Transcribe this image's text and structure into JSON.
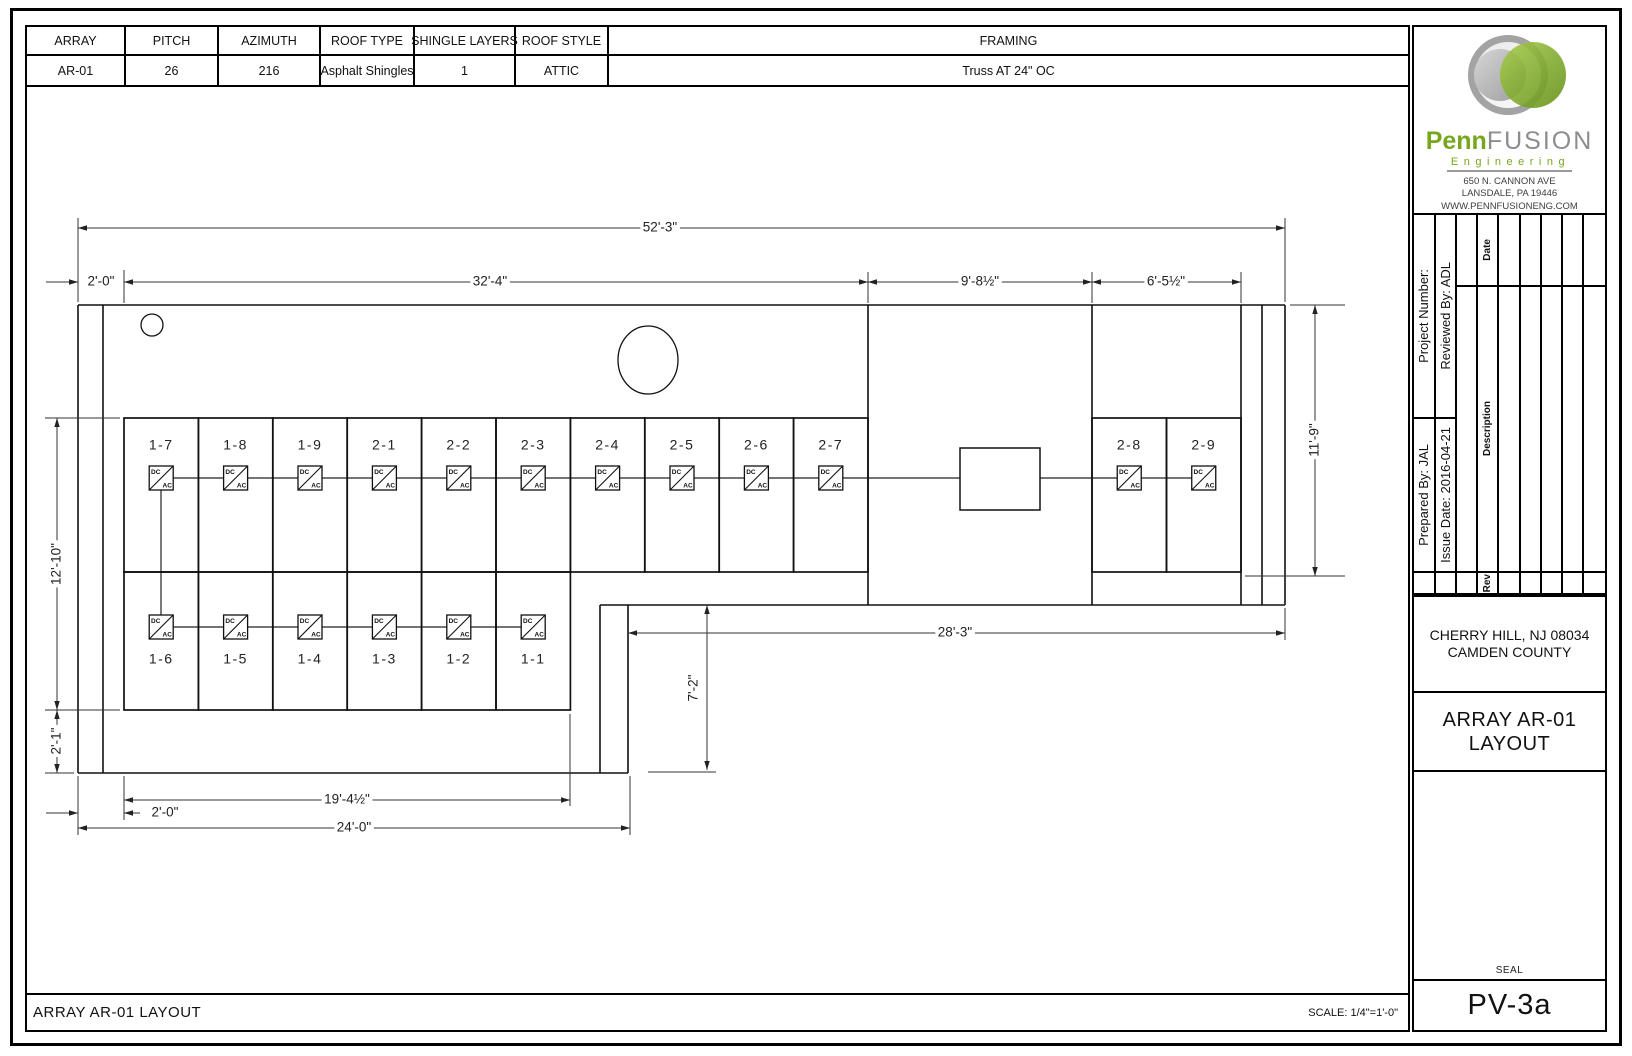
{
  "sheet": {
    "spec_table": {
      "headers": [
        "ARRAY",
        "PITCH",
        "AZIMUTH",
        "ROOF TYPE",
        "SHINGLE LAYERS",
        "ROOF STYLE",
        "FRAMING"
      ],
      "values": [
        "AR-01",
        "26",
        "216",
        "Asphalt Shingles",
        "1",
        "ATTIC",
        "Truss AT 24\" OC"
      ]
    },
    "footer": {
      "title": "ARRAY AR-01 LAYOUT",
      "scale": "SCALE: 1/4\"=1'-0\""
    },
    "title_block": {
      "logo": {
        "brand_primary": "Penn",
        "brand_secondary": "FUSION",
        "tagline": "Engineering",
        "address1": "650 N. CANNON AVE",
        "address2": "LANSDALE, PA 19446",
        "website": "WWW.PENNFUSIONENG.COM",
        "brand_green": "#76a71e",
        "brand_gray": "#8d8d8d"
      },
      "info": {
        "project_number": "Project Number:",
        "prepared_by": "Prepared By: JAL",
        "reviewed_by": "Reviewed By: ADL",
        "issue_date": "Issue Date: 2016-04-21"
      },
      "rev_table": {
        "date_label": "Date",
        "description_label": "Description",
        "rev_label": "Rev",
        "empty_columns": 5
      },
      "location_line1": "CHERRY HILL, NJ 08034",
      "location_line2": "CAMDEN COUNTY",
      "sheet_title_line1": "ARRAY AR-01",
      "sheet_title_line2": "LAYOUT",
      "seal_label": "SEAL",
      "sheet_number": "PV-3a"
    }
  },
  "drawing": {
    "inverter_labels": {
      "dc": "DC",
      "ac": "AC"
    },
    "outline": [
      [
        78,
        305,
        1285,
        305
      ],
      [
        78,
        305,
        78,
        773
      ],
      [
        103,
        305,
        103,
        773
      ],
      [
        78,
        773,
        628,
        773
      ],
      [
        600,
        605,
        600,
        773
      ],
      [
        628,
        605,
        628,
        773
      ],
      [
        600,
        605,
        1285,
        605
      ],
      [
        1285,
        305,
        1285,
        605
      ],
      [
        1262,
        305,
        1262,
        605
      ],
      [
        868,
        305,
        868,
        605
      ],
      [
        1092,
        305,
        1092,
        605
      ],
      [
        1241,
        305,
        1241,
        605
      ]
    ],
    "ext_lines": [
      [
        78,
        218,
        78,
        302
      ],
      [
        1285,
        218,
        1285,
        302
      ],
      [
        124,
        270,
        124,
        303
      ],
      [
        868,
        272,
        868,
        303
      ],
      [
        1092,
        272,
        1092,
        303
      ],
      [
        1241,
        272,
        1241,
        303
      ],
      [
        45,
        418,
        120,
        418
      ],
      [
        45,
        710,
        120,
        710
      ],
      [
        45,
        773,
        74,
        773
      ],
      [
        1290,
        305,
        1345,
        305
      ],
      [
        1245,
        576,
        1345,
        576
      ],
      [
        648,
        772,
        716,
        772
      ],
      [
        1285,
        608,
        1285,
        640
      ],
      [
        124,
        776,
        124,
        820
      ],
      [
        570,
        714,
        570,
        806
      ],
      [
        78,
        776,
        78,
        835
      ],
      [
        630,
        776,
        630,
        835
      ]
    ],
    "wires": [
      [
        161,
        478,
        1204,
        478
      ],
      [
        161,
        627,
        533,
        627
      ],
      [
        161,
        478,
        161,
        627
      ]
    ],
    "junction_box": {
      "x": 960,
      "y": 448,
      "w": 80,
      "h": 62
    },
    "circles": [
      {
        "cx": 152,
        "cy": 325,
        "rx": 11,
        "ry": 11
      },
      {
        "cx": 648,
        "cy": 360,
        "rx": 30,
        "ry": 34
      }
    ],
    "panels": [
      {
        "x": 124.0,
        "y": 418,
        "w": 74.4,
        "h": 154,
        "label": "1-7",
        "ly": 446,
        "iy": 478
      },
      {
        "x": 198.4,
        "y": 418,
        "w": 74.4,
        "h": 154,
        "label": "1-8",
        "ly": 446,
        "iy": 478
      },
      {
        "x": 272.8,
        "y": 418,
        "w": 74.4,
        "h": 154,
        "label": "1-9",
        "ly": 446,
        "iy": 478
      },
      {
        "x": 347.2,
        "y": 418,
        "w": 74.4,
        "h": 154,
        "label": "2-1",
        "ly": 446,
        "iy": 478
      },
      {
        "x": 421.6,
        "y": 418,
        "w": 74.4,
        "h": 154,
        "label": "2-2",
        "ly": 446,
        "iy": 478
      },
      {
        "x": 496.0,
        "y": 418,
        "w": 74.4,
        "h": 154,
        "label": "2-3",
        "ly": 446,
        "iy": 478
      },
      {
        "x": 570.4,
        "y": 418,
        "w": 74.4,
        "h": 154,
        "label": "2-4",
        "ly": 446,
        "iy": 478
      },
      {
        "x": 644.8,
        "y": 418,
        "w": 74.4,
        "h": 154,
        "label": "2-5",
        "ly": 446,
        "iy": 478
      },
      {
        "x": 719.2,
        "y": 418,
        "w": 74.4,
        "h": 154,
        "label": "2-6",
        "ly": 446,
        "iy": 478
      },
      {
        "x": 793.6,
        "y": 418,
        "w": 74.4,
        "h": 154,
        "label": "2-7",
        "ly": 446,
        "iy": 478
      },
      {
        "x": 1092.0,
        "y": 418,
        "w": 74.5,
        "h": 154,
        "label": "2-8",
        "ly": 446,
        "iy": 478
      },
      {
        "x": 1166.5,
        "y": 418,
        "w": 74.5,
        "h": 154,
        "label": "2-9",
        "ly": 446,
        "iy": 478
      },
      {
        "x": 124.0,
        "y": 572,
        "w": 74.4,
        "h": 138,
        "label": "1-6",
        "ly": 660,
        "iy": 627
      },
      {
        "x": 198.4,
        "y": 572,
        "w": 74.4,
        "h": 138,
        "label": "1-5",
        "ly": 660,
        "iy": 627
      },
      {
        "x": 272.8,
        "y": 572,
        "w": 74.4,
        "h": 138,
        "label": "1-4",
        "ly": 660,
        "iy": 627
      },
      {
        "x": 347.2,
        "y": 572,
        "w": 74.4,
        "h": 138,
        "label": "1-3",
        "ly": 660,
        "iy": 627
      },
      {
        "x": 421.6,
        "y": 572,
        "w": 74.4,
        "h": 138,
        "label": "1-2",
        "ly": 660,
        "iy": 627
      },
      {
        "x": 496.0,
        "y": 572,
        "w": 74.4,
        "h": 138,
        "label": "1-1",
        "ly": 660,
        "iy": 627
      }
    ],
    "dims": [
      {
        "segs": [
          [
            78,
            228,
            1285,
            228
          ]
        ],
        "arrows": [
          [
            78,
            228,
            "left"
          ],
          [
            1285,
            228,
            "right"
          ]
        ],
        "label": {
          "t": "52'-3\"",
          "x": 660,
          "y": 228
        }
      },
      {
        "segs": [
          [
            46,
            282,
            78,
            282
          ]
        ],
        "arrows": [
          [
            78,
            282,
            "right"
          ]
        ],
        "label": {
          "t": "2'-0\"",
          "x": 101,
          "y": 282
        }
      },
      {
        "segs": [
          [
            124,
            282,
            868,
            282
          ]
        ],
        "arrows": [
          [
            124,
            282,
            "left"
          ],
          [
            868,
            282,
            "right"
          ]
        ],
        "label": {
          "t": "32'-4\"",
          "x": 490,
          "y": 282
        }
      },
      {
        "segs": [
          [
            868,
            282,
            1092,
            282
          ]
        ],
        "arrows": [
          [
            868,
            282,
            "left"
          ],
          [
            1092,
            282,
            "right"
          ]
        ],
        "label": {
          "t": "9'-8½\"",
          "x": 980,
          "y": 282
        }
      },
      {
        "segs": [
          [
            1092,
            282,
            1241,
            282
          ]
        ],
        "arrows": [
          [
            1092,
            282,
            "left"
          ],
          [
            1241,
            282,
            "right"
          ]
        ],
        "label": {
          "t": "6'-5½\"",
          "x": 1166,
          "y": 282
        }
      },
      {
        "segs": [
          [
            57,
            418,
            57,
            710
          ]
        ],
        "arrows": [
          [
            57,
            418,
            "up"
          ],
          [
            57,
            710,
            "down"
          ]
        ],
        "label": {
          "t": "12'-10\"",
          "x": 57,
          "y": 564,
          "rot": true
        }
      },
      {
        "segs": [
          [
            57,
            710,
            57,
            773
          ]
        ],
        "arrows": [
          [
            57,
            710,
            "up"
          ],
          [
            57,
            773,
            "down"
          ]
        ],
        "label": {
          "t": "2'-1\"",
          "x": 57,
          "y": 741,
          "rot": true
        }
      },
      {
        "segs": [
          [
            1315,
            305,
            1315,
            576
          ]
        ],
        "arrows": [
          [
            1315,
            305,
            "up"
          ],
          [
            1315,
            576,
            "down"
          ]
        ],
        "label": {
          "t": "11'-9\"",
          "x": 1315,
          "y": 440,
          "rot": true
        }
      },
      {
        "segs": [
          [
            707,
            605,
            707,
            770
          ]
        ],
        "arrows": [
          [
            707,
            605,
            "up"
          ],
          [
            707,
            770,
            "down"
          ]
        ],
        "label": {
          "t": "7'-2\"",
          "x": 694,
          "y": 688,
          "rot": true
        }
      },
      {
        "segs": [
          [
            628,
            633,
            1285,
            633
          ]
        ],
        "arrows": [
          [
            628,
            633,
            "left"
          ],
          [
            1285,
            633,
            "right"
          ]
        ],
        "label": {
          "t": "28'-3\"",
          "x": 955,
          "y": 633
        }
      },
      {
        "segs": [
          [
            124,
            800,
            570,
            800
          ]
        ],
        "arrows": [
          [
            124,
            800,
            "left"
          ],
          [
            570,
            800,
            "right"
          ]
        ],
        "label": {
          "t": "19'-4½\"",
          "x": 347,
          "y": 800
        }
      },
      {
        "segs": [
          [
            46,
            813,
            78,
            813
          ],
          [
            124,
            813,
            140,
            813
          ]
        ],
        "arrows": [
          [
            78,
            813,
            "right"
          ],
          [
            124,
            813,
            "left"
          ]
        ],
        "label": {
          "t": "2'-0\"",
          "x": 165,
          "y": 813
        }
      },
      {
        "segs": [
          [
            78,
            828,
            630,
            828
          ]
        ],
        "arrows": [
          [
            78,
            828,
            "left"
          ],
          [
            630,
            828,
            "right"
          ]
        ],
        "label": {
          "t": "24'-0\"",
          "x": 354,
          "y": 828
        }
      }
    ]
  }
}
